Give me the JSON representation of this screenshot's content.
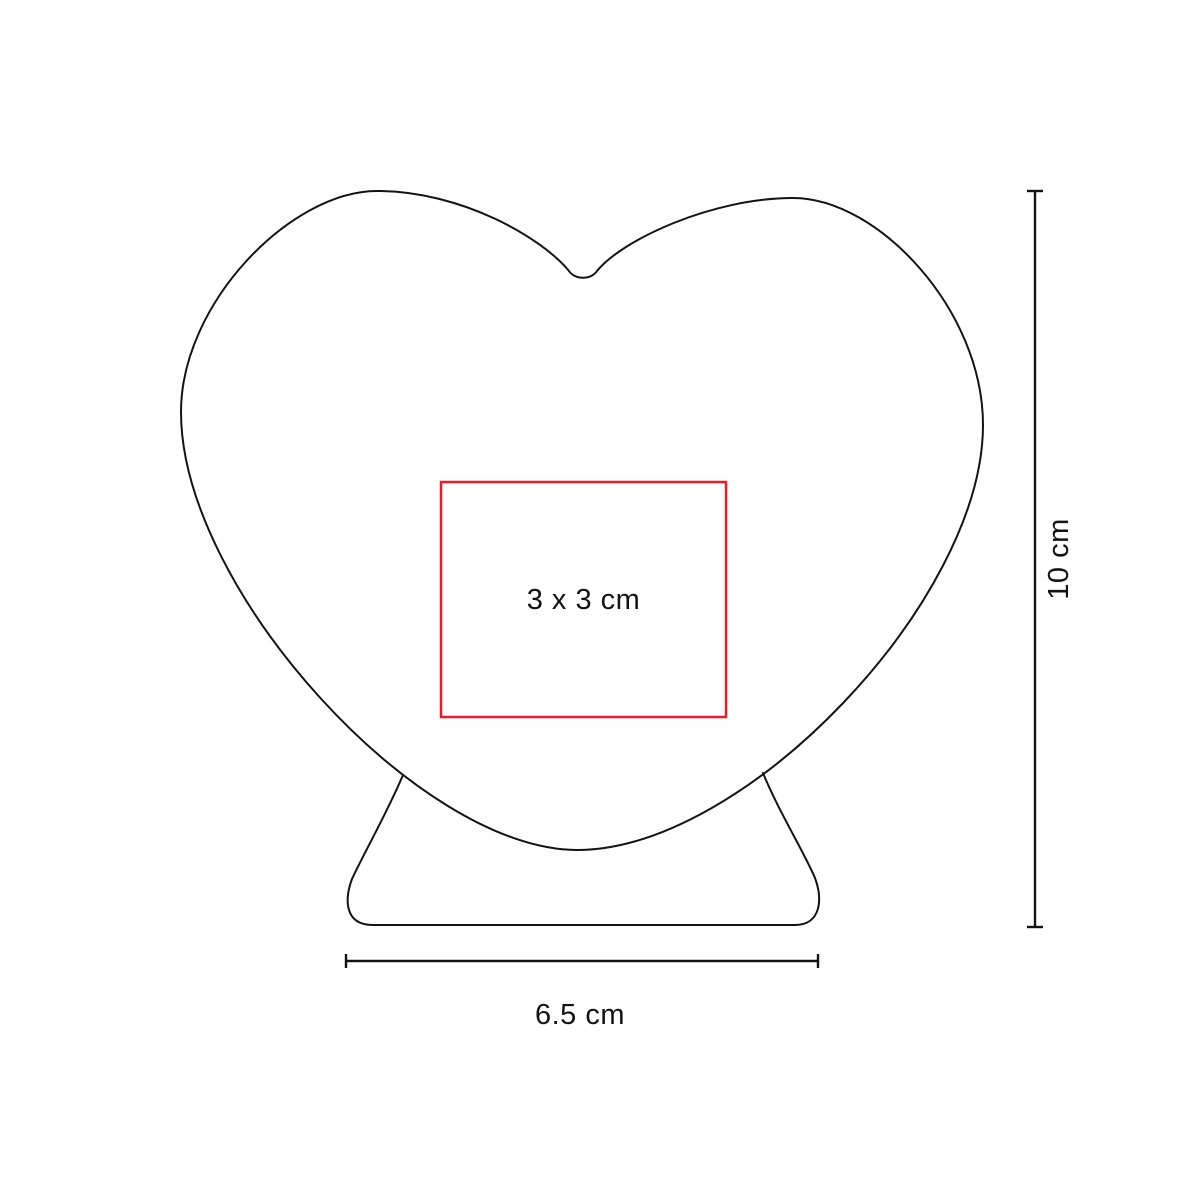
{
  "diagram": {
    "background_color": "#FFFFFF",
    "outline_color": "#131313",
    "product_shape": "heart-on-stand",
    "print_area": {
      "label": "3 x 3 cm",
      "border_color": "#ED1C24"
    },
    "height_dimension": {
      "label": "10 cm"
    },
    "width_dimension": {
      "label": "6.5 cm"
    }
  }
}
